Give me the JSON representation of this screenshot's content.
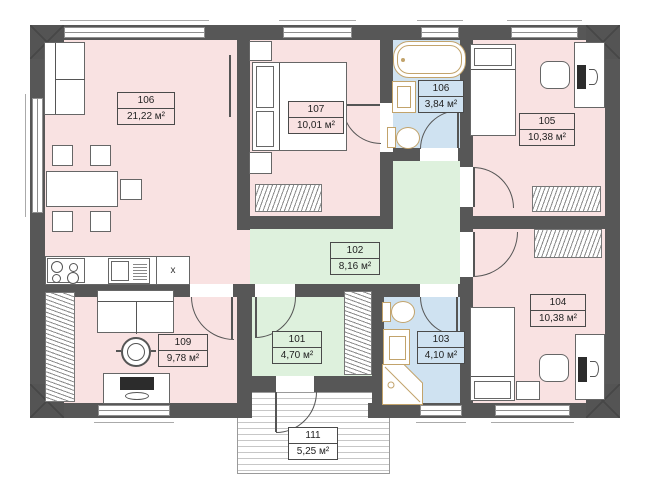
{
  "plan": {
    "labels": [
      {
        "number": "106",
        "area": "21,22 м²"
      },
      {
        "number": "107",
        "area": "10,01 м²"
      },
      {
        "number": "106",
        "area": "3,84 м²"
      },
      {
        "number": "105",
        "area": "10,38 м²"
      },
      {
        "number": "102",
        "area": "8,16 м²"
      },
      {
        "number": "101",
        "area": "4,70 м²"
      },
      {
        "number": "103",
        "area": "4,10 м²"
      },
      {
        "number": "104",
        "area": "10,38 м²"
      },
      {
        "number": "109",
        "area": "9,78 м²"
      },
      {
        "number": "111",
        "area": "5,25 м²"
      }
    ],
    "kitchen_sink_marker": "x",
    "colors": {
      "wall": "#575757",
      "room_pink": "#f9e2e2",
      "hall_green": "#def1dd",
      "bath_blue": "#cfe2f1",
      "fixture_tan": "#c2a36b"
    }
  }
}
